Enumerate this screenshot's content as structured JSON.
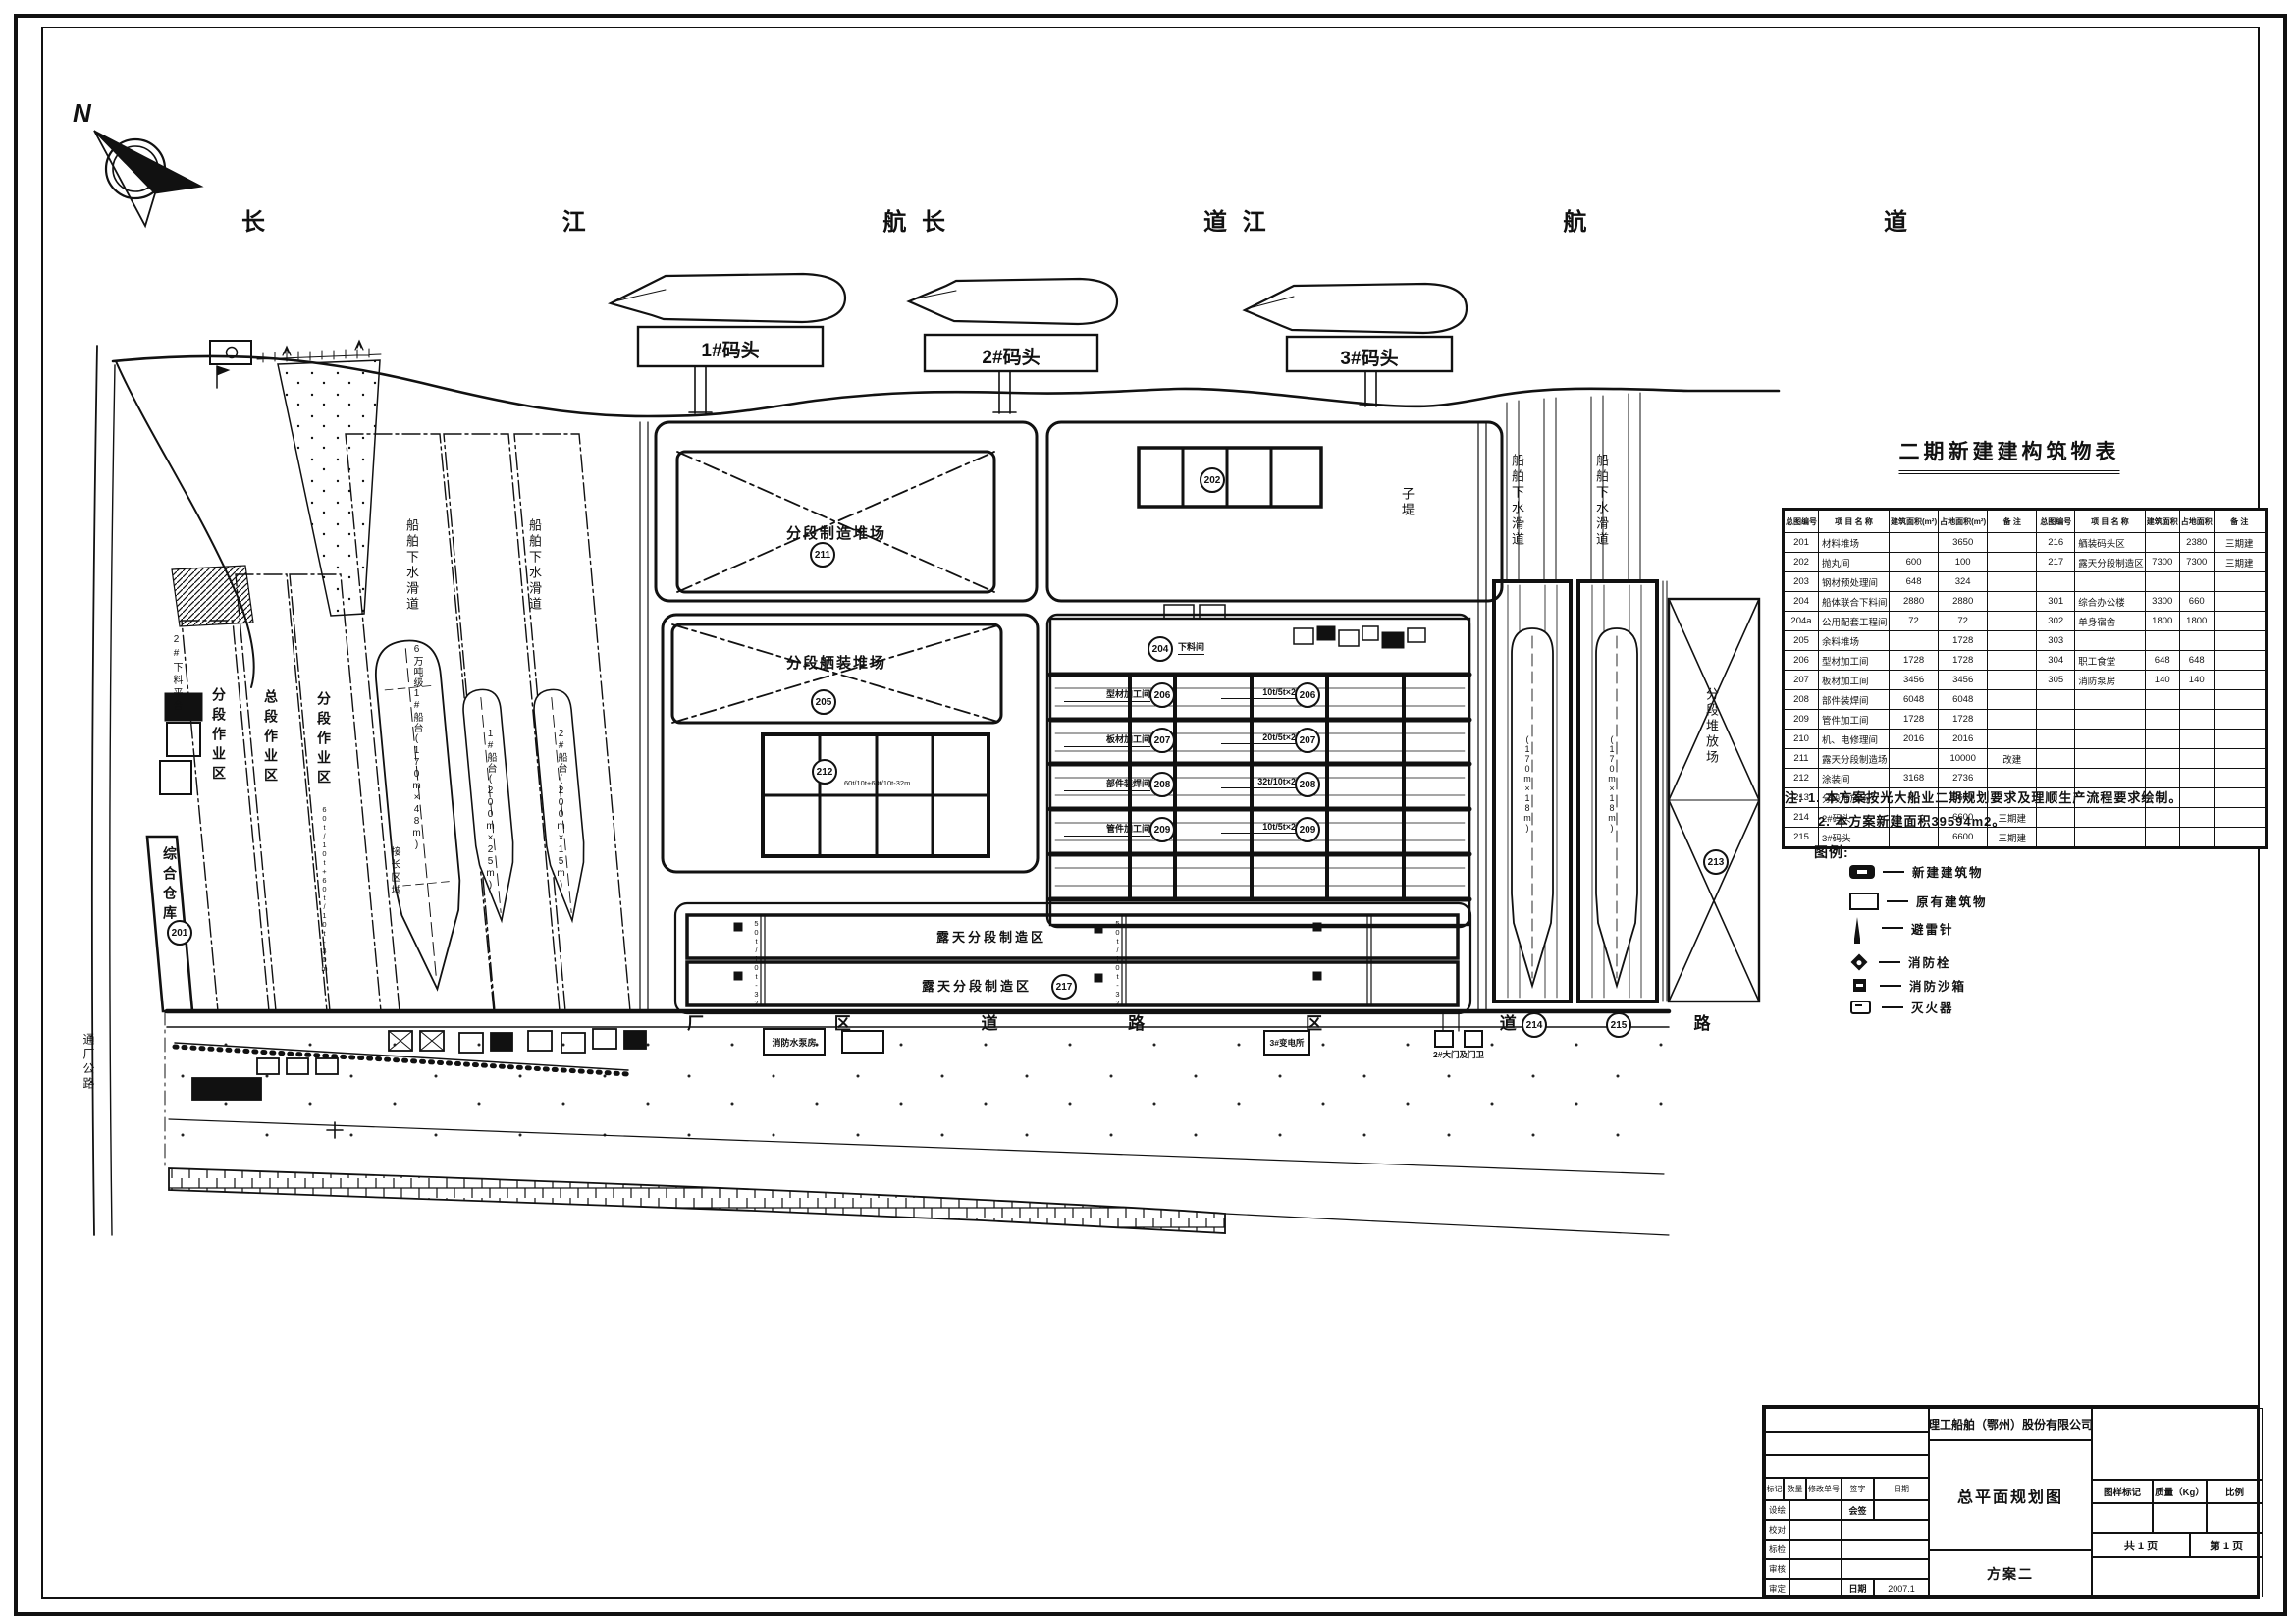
{
  "compass": {
    "n": "N"
  },
  "river": {
    "label": "长 江 航 道"
  },
  "piers": {
    "p1": "1#码头",
    "p2": "2#码头",
    "p3": "3#码头"
  },
  "plan": {
    "slipway_label": "船舶下水滑道",
    "zones": {
      "fenduan": "分段作业区",
      "zongduan": "总段作业区",
      "warehouse": "综合仓库",
      "platform": "2#下料平台",
      "joint": "接长区域",
      "zidi": "子堤"
    },
    "berths": {
      "b1": "6万吨级1#船台(170m×48m)",
      "b2": "1#船台(200m×25m)",
      "b3": "2#船台(200m×15m)",
      "dim": "(170m×18m)"
    },
    "yards": {
      "zhizao": "分段制造堆场",
      "xizhuang": "分段舾装堆场",
      "open_air": "露天分段制造区",
      "stack": "分段堆放场"
    },
    "road": {
      "main": "厂 区 道 路",
      "main2": "区 道 路",
      "offsite": "通厂公路"
    },
    "small_buildings": {
      "pump": "消防水泵房",
      "substation": "3#变电所",
      "gate": "2#大门及门卫"
    },
    "workshops": {
      "top_label": "下料间",
      "left": [
        "型材加工间",
        "板材加工间",
        "部件装焊间",
        "管件加工间"
      ],
      "right": [
        "10t/5t×2",
        "20t/5t×2",
        "32t/10t×2",
        "10t/5t×2"
      ]
    },
    "crane_notes": {
      "n1": "60t/10t+60t/10t-32m",
      "n2": "50t/10t-32m",
      "n3": "60t/10t+60t/10t-30m"
    },
    "circles": {
      "xrect1": "211",
      "xrect2": "205",
      "grid": "212",
      "topcell": "202",
      "warehouse": "201",
      "open": "217",
      "stack": "213",
      "complex_top": "204",
      "bay1": "206",
      "bay2": "207",
      "bay3": "208",
      "bay4": "209",
      "ch1": "214",
      "ch2": "215"
    }
  },
  "table": {
    "title": "二期新建建构筑物表",
    "headers": [
      "总图编号",
      "项 目 名 称",
      "建筑面积(m²)",
      "占地面积(m²)",
      "备  注",
      "总图编号",
      "项 目 名 称",
      "建筑面积",
      "占地面积",
      "备  注"
    ],
    "rows": [
      [
        "201",
        "材料堆场",
        "",
        "3650",
        "",
        "216",
        "舾装码头区",
        "",
        "2380",
        "三期建"
      ],
      [
        "202",
        "抛丸间",
        "600",
        "100",
        "",
        "217",
        "露天分段制造区",
        "7300",
        "7300",
        "三期建"
      ],
      [
        "203",
        "钢材预处理间",
        "648",
        "324",
        "",
        "",
        "",
        "",
        "",
        ""
      ],
      [
        "204",
        "船体联合下料间",
        "2880",
        "2880",
        "",
        "301",
        "综合办公楼",
        "3300",
        "660",
        ""
      ],
      [
        "204a",
        "公用配套工程间",
        "72",
        "72",
        "",
        "302",
        "单身宿舍",
        "1800",
        "1800",
        ""
      ],
      [
        "205",
        "余料堆场",
        "",
        "1728",
        "",
        "303",
        "",
        "",
        "",
        ""
      ],
      [
        "206",
        "型材加工间",
        "1728",
        "1728",
        "",
        "304",
        "职工食堂",
        "648",
        "648",
        ""
      ],
      [
        "207",
        "板材加工间",
        "3456",
        "3456",
        "",
        "305",
        "消防泵房",
        "140",
        "140",
        ""
      ],
      [
        "208",
        "部件装焊间",
        "6048",
        "6048",
        "",
        "",
        "",
        "",
        "",
        ""
      ],
      [
        "209",
        "管件加工间",
        "1728",
        "1728",
        "",
        "",
        "",
        "",
        "",
        ""
      ],
      [
        "210",
        "机、电修理间",
        "2016",
        "2016",
        "",
        "",
        "",
        "",
        "",
        ""
      ],
      [
        "211",
        "露天分段制造场",
        "",
        "10000",
        "改建",
        "",
        "",
        "",
        "",
        ""
      ],
      [
        "212",
        "涂装间",
        "3168",
        "2736",
        "",
        "",
        "",
        "",
        "",
        ""
      ],
      [
        "213",
        "分段堆放场",
        "",
        "5600",
        "",
        "",
        "",
        "",
        "",
        ""
      ],
      [
        "214",
        "2#码头",
        "",
        "6600",
        "三期建",
        "",
        "",
        "",
        "",
        ""
      ],
      [
        "215",
        "3#码头",
        "",
        "6600",
        "三期建",
        "",
        "",
        "",
        "",
        ""
      ]
    ]
  },
  "notes": {
    "line1": "注: 1. 本方案按光大船业二期规划要求及理顺生产流程要求绘制。",
    "line2": "2. 本方案新建面积39594m2。"
  },
  "legend": {
    "title": "图例:",
    "items": [
      {
        "label": "新建建筑物"
      },
      {
        "label": "原有建筑物"
      },
      {
        "label": "避雷针"
      },
      {
        "label": "消防栓"
      },
      {
        "label": "消防沙箱"
      },
      {
        "label": "灭火器"
      }
    ]
  },
  "titleblock": {
    "company": "理工船舶（鄂州）股份有限公司",
    "drawing_title": "总平面规划图",
    "scheme": "方案二",
    "mark_header": [
      "标记",
      "数量",
      "修改单号",
      "签字",
      "日期"
    ],
    "roles": [
      "设绘",
      "校对",
      "标检",
      "审核",
      "审定"
    ],
    "countersign": "会签",
    "date_label": "日期",
    "date_value": "2007.1",
    "right_header": [
      "图样标记",
      "质量（Kg）",
      "比例"
    ],
    "pages_total": "共 1 页",
    "page_no": "第 1 页"
  }
}
